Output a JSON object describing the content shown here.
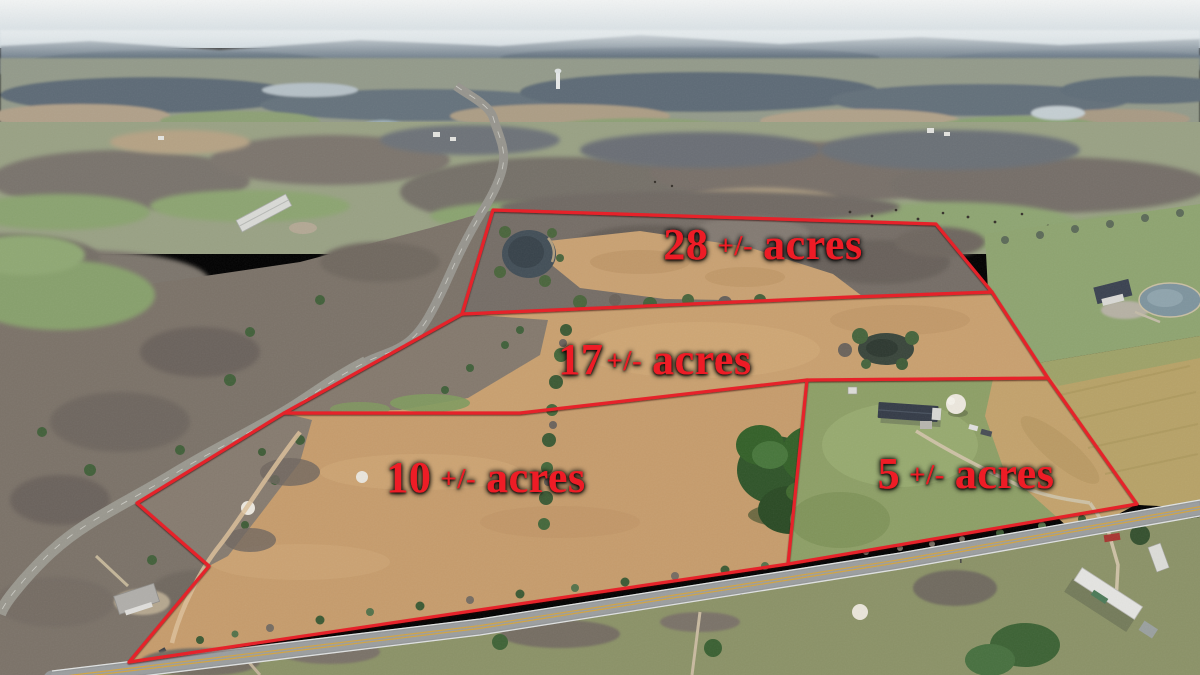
{
  "image": {
    "description": "Aerial drone photo of farmland for sale, winter, with four parcels outlined in red over tan hay fields, woods, two roads, ponds and farm houses",
    "boundary_color": "#e62329",
    "label_color": "#ee1c25"
  },
  "parcels": [
    {
      "id": "parcel-28",
      "area": "28",
      "pm": "+/-",
      "unit": "acres",
      "label": "28 +/- acres",
      "acres_value": 28
    },
    {
      "id": "parcel-17",
      "area": "17",
      "pm": "+/-",
      "unit": "acres",
      "label": "17+/- acres",
      "acres_value": 17
    },
    {
      "id": "parcel-10",
      "area": "10",
      "pm": "+/-",
      "unit": "acres",
      "label": "10 +/- acres",
      "acres_value": 10
    },
    {
      "id": "parcel-5",
      "area": "5",
      "pm": "+/-",
      "unit": "acres",
      "label": "5 +/- acres",
      "acres_value": 5
    }
  ]
}
